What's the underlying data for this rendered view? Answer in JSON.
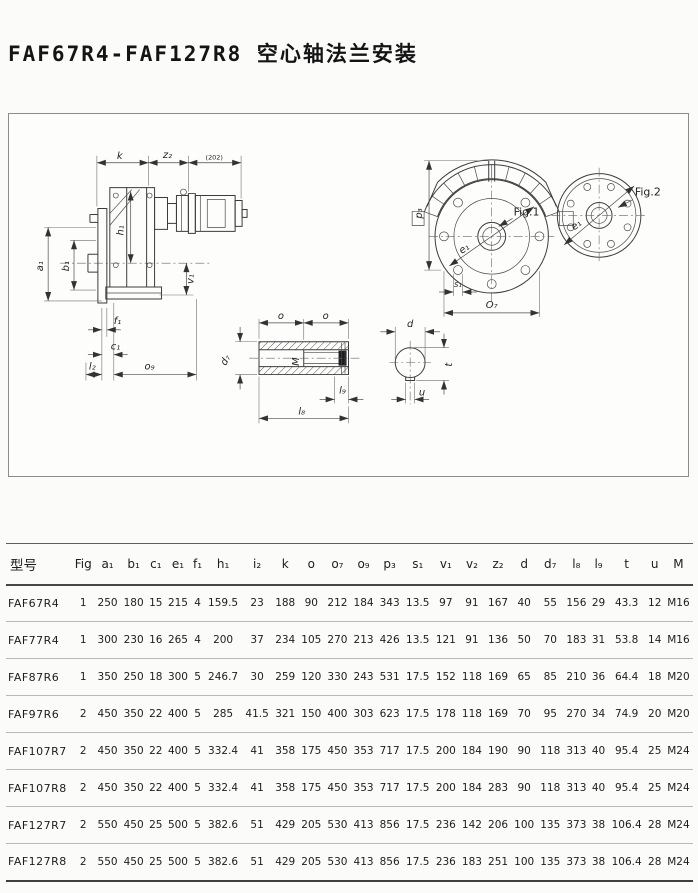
{
  "page": {
    "title": "FAF67R4-FAF127R8 空心轴法兰安装"
  },
  "drawing": {
    "labels": {
      "k": "k",
      "z2": "z₂",
      "ref": "(202)",
      "a1": "a₁",
      "b1": "b₁",
      "h1": "h₁",
      "v1": "v₁",
      "f1": "f₁",
      "c1": "c₁",
      "l2": "l₂",
      "o9": "o₉",
      "p3": "p₃",
      "s1": "s₁",
      "o7": "O₇",
      "fig1": "Fig.1",
      "fig2": "Fig.2",
      "e1a": "e₁",
      "e1b": "e₁",
      "o_a": "o",
      "o_b": "o",
      "d7": "d₇",
      "thread": "M",
      "l8": "l₈",
      "l9": "l₉",
      "d": "d",
      "t": "t",
      "u": "u"
    }
  },
  "table": {
    "headers": [
      "型号",
      "Fig",
      "a₁",
      "b₁",
      "c₁",
      "e₁",
      "f₁",
      "h₁",
      "i₂",
      "k",
      "o",
      "o₇",
      "o₉",
      "p₃",
      "s₁",
      "v₁",
      "v₂",
      "z₂",
      "d",
      "d₇",
      "l₈",
      "l₉",
      "t",
      "u",
      "M"
    ],
    "rows": [
      {
        "model": "FAF67R4",
        "values": [
          "1",
          "250",
          "180",
          "15",
          "215",
          "4",
          "159.5",
          "23",
          "188",
          "90",
          "212",
          "184",
          "343",
          "13.5",
          "97",
          "91",
          "167",
          "40",
          "55",
          "156",
          "29",
          "43.3",
          "12",
          "M16"
        ]
      },
      {
        "model": "FAF77R4",
        "values": [
          "1",
          "300",
          "230",
          "16",
          "265",
          "4",
          "200",
          "37",
          "234",
          "105",
          "270",
          "213",
          "426",
          "13.5",
          "121",
          "91",
          "136",
          "50",
          "70",
          "183",
          "31",
          "53.8",
          "14",
          "M16"
        ]
      },
      {
        "model": "FAF87R6",
        "values": [
          "1",
          "350",
          "250",
          "18",
          "300",
          "5",
          "246.7",
          "30",
          "259",
          "120",
          "330",
          "243",
          "531",
          "17.5",
          "152",
          "118",
          "169",
          "65",
          "85",
          "210",
          "36",
          "64.4",
          "18",
          "M20"
        ]
      },
      {
        "model": "FAF97R6",
        "values": [
          "2",
          "450",
          "350",
          "22",
          "400",
          "5",
          "285",
          "41.5",
          "321",
          "150",
          "400",
          "303",
          "623",
          "17.5",
          "178",
          "118",
          "169",
          "70",
          "95",
          "270",
          "34",
          "74.9",
          "20",
          "M20"
        ]
      },
      {
        "model": "FAF107R7",
        "values": [
          "2",
          "450",
          "350",
          "22",
          "400",
          "5",
          "332.4",
          "41",
          "358",
          "175",
          "450",
          "353",
          "717",
          "17.5",
          "200",
          "184",
          "190",
          "90",
          "118",
          "313",
          "40",
          "95.4",
          "25",
          "M24"
        ]
      },
      {
        "model": "FAF107R8",
        "values": [
          "2",
          "450",
          "350",
          "22",
          "400",
          "5",
          "332.4",
          "41",
          "358",
          "175",
          "450",
          "353",
          "717",
          "17.5",
          "200",
          "184",
          "283",
          "90",
          "118",
          "313",
          "40",
          "95.4",
          "25",
          "M24"
        ]
      },
      {
        "model": "FAF127R7",
        "values": [
          "2",
          "550",
          "450",
          "25",
          "500",
          "5",
          "382.6",
          "51",
          "429",
          "205",
          "530",
          "413",
          "856",
          "17.5",
          "236",
          "142",
          "206",
          "100",
          "135",
          "373",
          "38",
          "106.4",
          "28",
          "M24"
        ]
      },
      {
        "model": "FAF127R8",
        "values": [
          "2",
          "550",
          "450",
          "25",
          "500",
          "5",
          "382.6",
          "51",
          "429",
          "205",
          "530",
          "413",
          "856",
          "17.5",
          "236",
          "183",
          "251",
          "100",
          "135",
          "373",
          "38",
          "106.4",
          "28",
          "M24"
        ]
      }
    ]
  }
}
